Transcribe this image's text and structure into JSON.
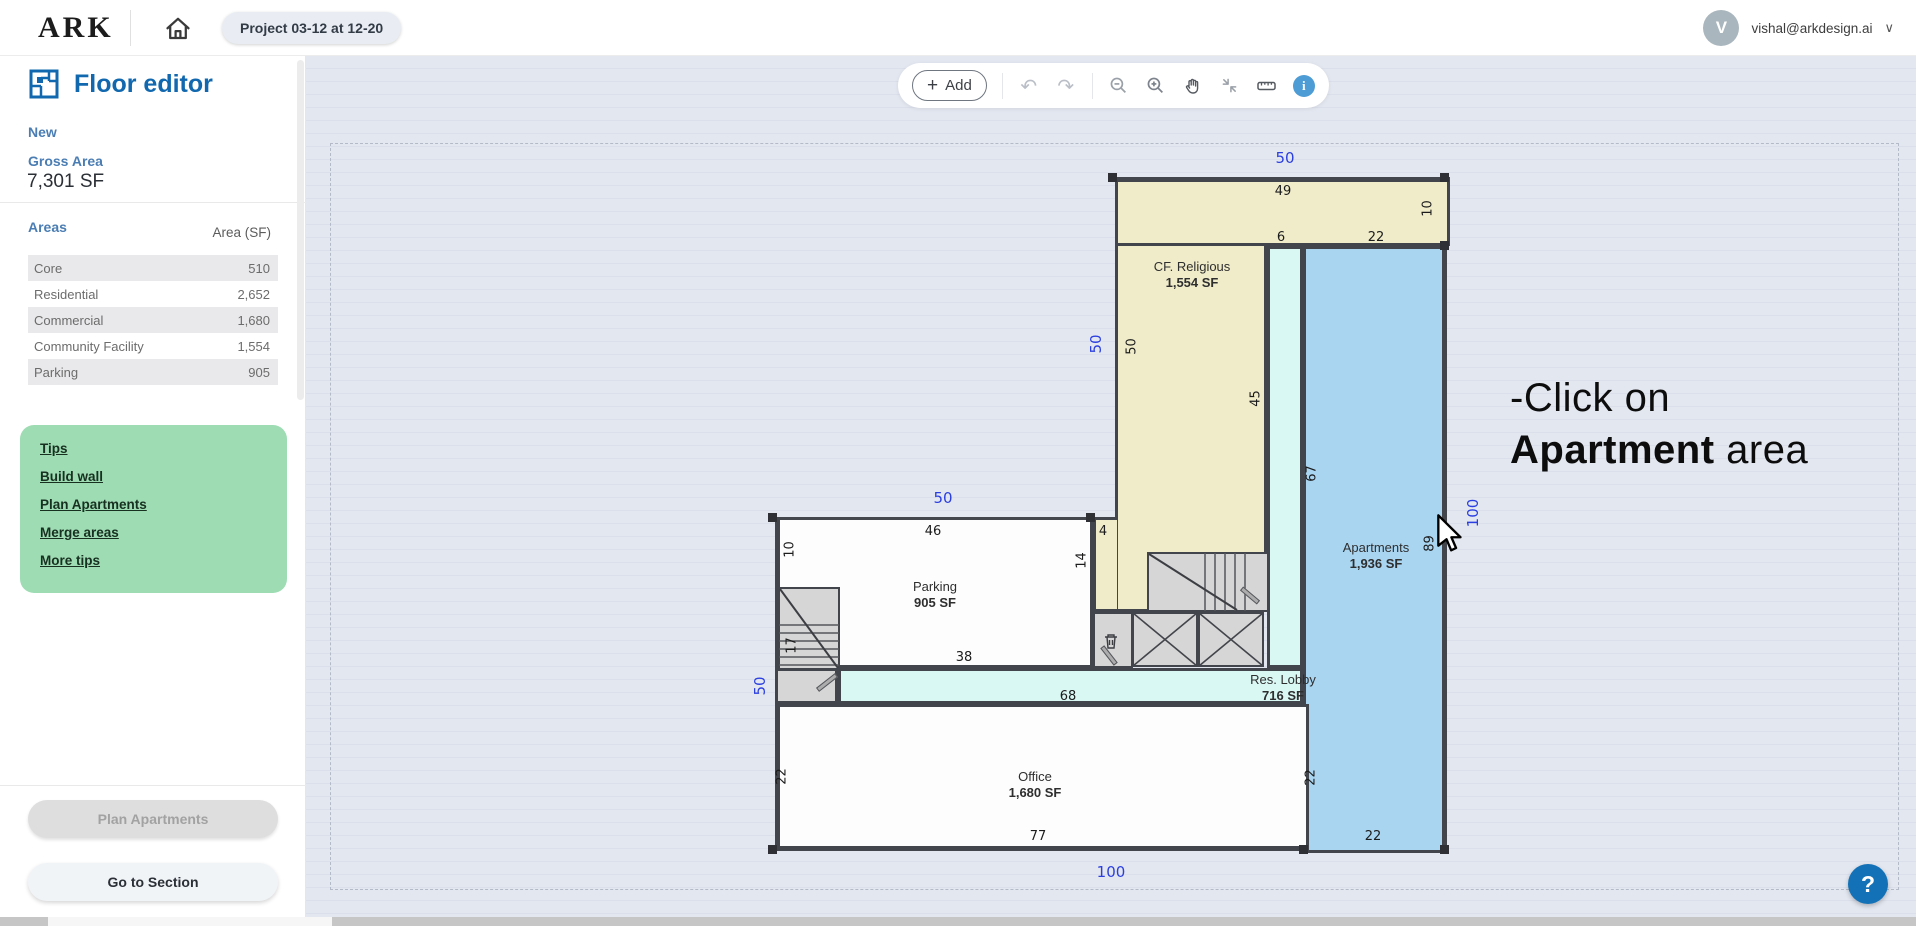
{
  "topbar": {
    "logo": "ARK",
    "project": "Project 03-12 at 12-20",
    "email": "vishal@arkdesign.ai",
    "avatar_initial": "V",
    "chevron": "∨"
  },
  "sidebar": {
    "title": "Floor editor",
    "new_link": "New",
    "gross_area_label": "Gross Area",
    "gross_area_value": "7,301 SF",
    "areas_label": "Areas",
    "area_col_header": "Area (SF)",
    "area_rows": [
      {
        "name": "Core",
        "value": "510"
      },
      {
        "name": "Residential",
        "value": "2,652"
      },
      {
        "name": "Commercial",
        "value": "1,680"
      },
      {
        "name": "Community Facility",
        "value": "1,554"
      },
      {
        "name": "Parking",
        "value": "905"
      }
    ],
    "tips": {
      "heading": "Tips",
      "links": [
        "Build wall",
        "Plan Apartments",
        "Merge areas",
        "More tips"
      ]
    },
    "plan_apartments_button": "Plan Apartments",
    "go_to_section_button": "Go to Section"
  },
  "toolbar": {
    "plus": "+",
    "add_label": "Add",
    "undo_glyph": "↶",
    "redo_glyph": "↷",
    "info_glyph": "i"
  },
  "overlay": {
    "instruction_line1": "-Click on",
    "instruction_bold": "Apartment",
    "instruction_rest": " area",
    "help": "?"
  },
  "plan": {
    "rooms": [
      {
        "name": "CF. Religious",
        "area": "1,554 SF"
      },
      {
        "name": "Apartments",
        "area": "1,936 SF"
      },
      {
        "name": "Parking",
        "area": "905 SF"
      },
      {
        "name": "Res. Lobby",
        "area": "716 SF"
      },
      {
        "name": "Office",
        "area": "1,680 SF"
      }
    ],
    "dims": [
      "49",
      "10",
      "6",
      "22",
      "50",
      "45",
      "67",
      "89",
      "46",
      "10",
      "4",
      "14",
      "17",
      "38",
      "68",
      "22",
      "77",
      "22",
      "22"
    ],
    "blue_dims": [
      "50",
      "50",
      "50",
      "50",
      "100",
      "100"
    ]
  },
  "colors": {
    "accent_blue": "#1268ae",
    "dim_blue": "#2b3fe0",
    "tips_green": "#9edcb4",
    "apartment_fill": "#a9d5f1",
    "religious_fill": "#f0ecca",
    "lobby_fill": "#d9f7f3",
    "core_gray": "#d6d6d6",
    "wall": "#43454c",
    "help_blue": "#1372b7"
  }
}
